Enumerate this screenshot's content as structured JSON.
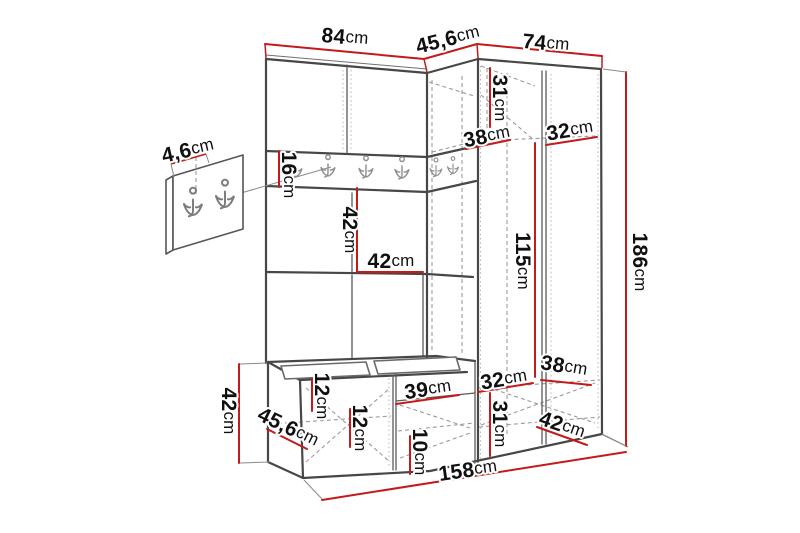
{
  "diagram": {
    "type": "furniture-dimension-drawing",
    "unit": "cm",
    "colors": {
      "dimension_line": "#c41a1a",
      "outline": "#474747",
      "hidden_line": "#9b9b9b",
      "label_text": "#101010",
      "background": "#ffffff"
    },
    "icons": {
      "coat-hook-icon": "wall-mounted double coat hook",
      "rail_hook_count": 6,
      "panel_hook_count": 2
    }
  },
  "labels": [
    {
      "value": "84",
      "unit": "cm",
      "name": "top-width-left"
    },
    {
      "value": "45,6",
      "unit": "cm",
      "name": "top-width-corner"
    },
    {
      "value": "74",
      "unit": "cm",
      "name": "top-width-right"
    },
    {
      "value": "4,6",
      "unit": "cm",
      "name": "hook-panel-thickness"
    },
    {
      "value": "16",
      "unit": "cm",
      "name": "hook-rail-height"
    },
    {
      "value": "31",
      "unit": "cm",
      "name": "upper-corner-inner-height"
    },
    {
      "value": "38",
      "unit": "cm",
      "name": "upper-shelf-depth"
    },
    {
      "value": "32",
      "unit": "cm",
      "name": "upper-shelf-width"
    },
    {
      "value": "42",
      "unit": "cm",
      "name": "middle-inner-height"
    },
    {
      "value": "42",
      "unit": "cm",
      "name": "middle-shelf-width"
    },
    {
      "value": "115",
      "unit": "cm",
      "name": "wardrobe-inner-height"
    },
    {
      "value": "186",
      "unit": "cm",
      "name": "total-height"
    },
    {
      "value": "42",
      "unit": "cm",
      "name": "bench-height"
    },
    {
      "value": "45,6",
      "unit": "cm",
      "name": "bench-depth"
    },
    {
      "value": "12",
      "unit": "cm",
      "name": "bench-inner-height-upper"
    },
    {
      "value": "12",
      "unit": "cm",
      "name": "bench-inner-height-lower"
    },
    {
      "value": "39",
      "unit": "cm",
      "name": "shoe-shelf-width"
    },
    {
      "value": "10",
      "unit": "cm",
      "name": "shoe-shelf-height"
    },
    {
      "value": "32",
      "unit": "cm",
      "name": "lower-shelf-width"
    },
    {
      "value": "31",
      "unit": "cm",
      "name": "lower-inner-height"
    },
    {
      "value": "38",
      "unit": "cm",
      "name": "lower-shelf-depth"
    },
    {
      "value": "42",
      "unit": "cm",
      "name": "lower-compartment-depth"
    },
    {
      "value": "158",
      "unit": "cm",
      "name": "total-width"
    }
  ]
}
